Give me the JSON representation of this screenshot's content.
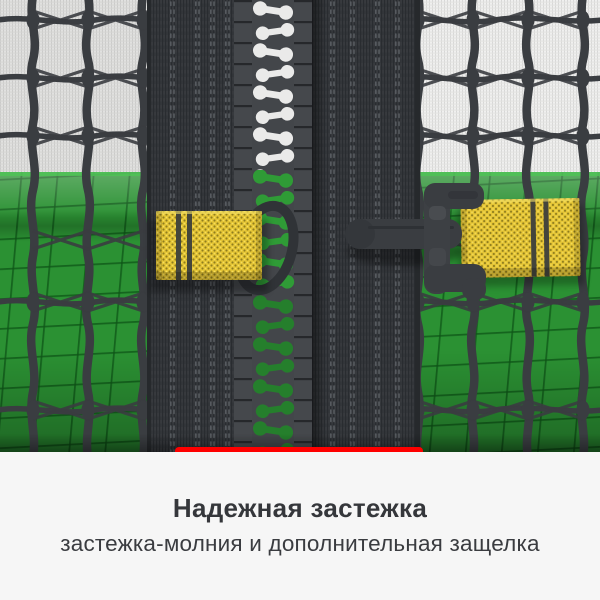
{
  "caption": {
    "title": "Надежная застежка",
    "subtitle": "застежка-молния и дополнительная защелка"
  },
  "colors": {
    "accent": "#fe0000",
    "pad_green": "#2b9133",
    "strap_yellow": "#e6c636",
    "webbing_dark": "#34373b",
    "mesh_light": "#f0f0ef",
    "caption_bg": "#f6f6f6",
    "title_text": "#35373b",
    "subtitle_text": "#3a3c40"
  }
}
